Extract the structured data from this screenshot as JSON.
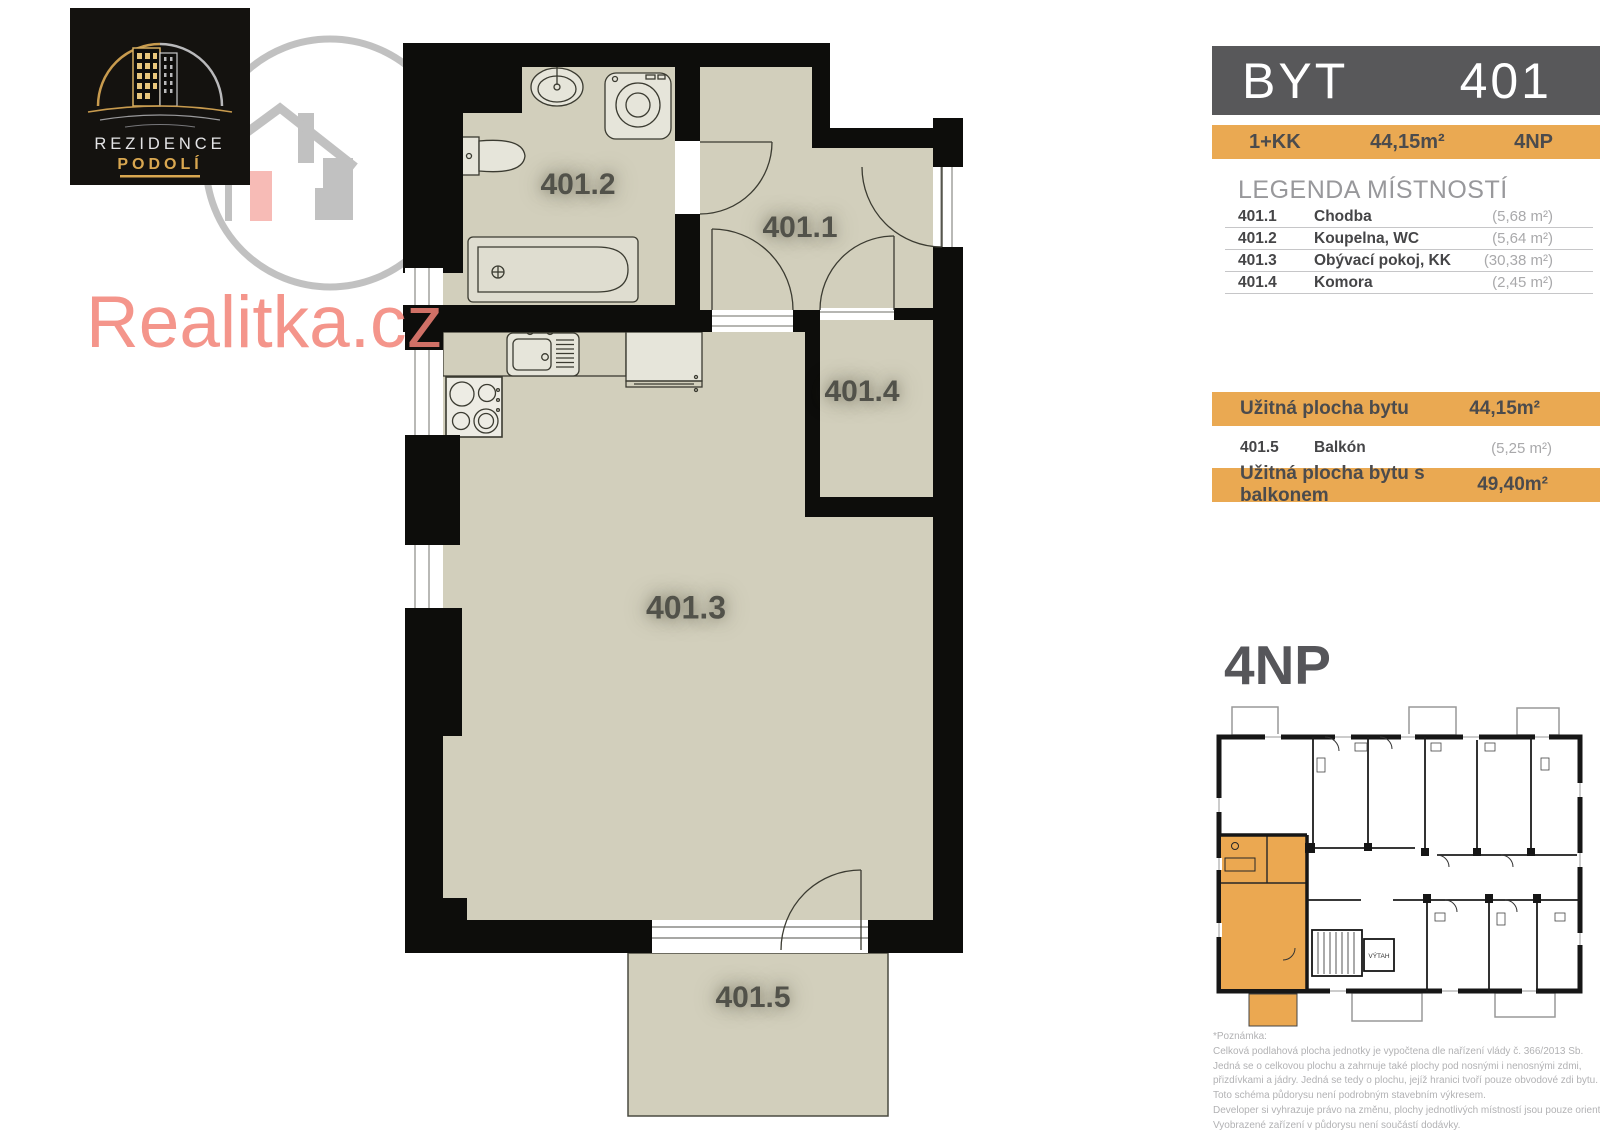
{
  "branding": {
    "logo": {
      "line1": "REZIDENCE",
      "line2": "PODOLÍ"
    },
    "watermark": "Realitka.cz"
  },
  "header": {
    "title": "BYT",
    "number": "401"
  },
  "summary": {
    "layout": "1+KK",
    "area": "44,15m²",
    "floor": "4NP"
  },
  "legend": {
    "title": "LEGENDA MÍSTNOSTÍ",
    "rooms": [
      {
        "id": "401.1",
        "name": "Chodba",
        "area": "(5,68 m²)"
      },
      {
        "id": "401.2",
        "name": "Koupelna, WC",
        "area": "(5,64 m²)"
      },
      {
        "id": "401.3",
        "name": "Obývací pokoj, KK",
        "area": "(30,38 m²)"
      },
      {
        "id": "401.4",
        "name": "Komora",
        "area": "(2,45 m²)"
      }
    ],
    "usable": {
      "label": "Užitná plocha bytu",
      "value": "44,15m²"
    },
    "balcony_row": {
      "id": "401.5",
      "name": "Balkón",
      "area": "(5,25 m²)"
    },
    "usable_with_balcony": {
      "label": "Užitná plocha bytu s balkonem",
      "value": "49,40m²"
    }
  },
  "floor_plan": {
    "labels": {
      "hall": "401.1",
      "bath": "401.2",
      "living": "401.3",
      "storage": "401.4",
      "balcony": "401.5"
    }
  },
  "mini_plan": {
    "title": "4NP",
    "elevator": "VÝTAH"
  },
  "footnote": {
    "lines": [
      "*Poznámka:",
      "Celková podlahová plocha jednotky je vypočtena dle nařízení vlády č. 366/2013 Sb.",
      "Jedná se o celkovou plochu a zahrnuje také plochy pod nosnými i nenosnými zdmi,",
      "přizdívkami a jádry. Jedná se tedy o plochu, jejíž hranici tvoří pouze obvodové zdi bytu.",
      "Toto schéma půdorysu není podrobným stavebním výkresem.",
      "Developer si vyhrazuje právo na změnu, plochy jednotlivých místností jsou pouze orientační.",
      "Vyobrazené zařízení v půdorysu není součástí dodávky."
    ]
  },
  "colors": {
    "accent": "#EAA952",
    "wall": "#0D0D0B",
    "floor": "#D2CFBC",
    "header_bar": "#58585A",
    "watermark_red": "#F28277"
  }
}
